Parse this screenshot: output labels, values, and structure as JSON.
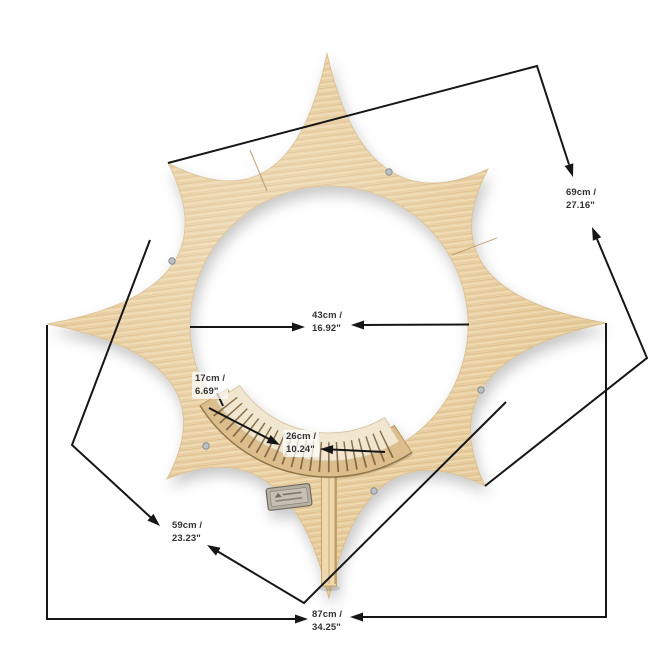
{
  "diagram": {
    "type": "product-dimension-diagram",
    "background_color": "#ffffff",
    "line_color": "#161616",
    "label_text_color": "#333333",
    "product": {
      "description": "eight-point sun-shaped wooden wall shelf with round opening, slotted display rack, support leg and brand plaque",
      "wood_color": "#e9cfa0",
      "wood_grain_color": "#cfa96e",
      "rack_card_color": "#f1e7d0",
      "rack_slot_color": "#775c38",
      "leg_color": "#eed9ae",
      "plaque_color": "#b6b0a4",
      "screw_color": "#b9c0c6"
    },
    "dimensions": {
      "height": {
        "cm": "69cm /",
        "inch": "27.16\""
      },
      "opening_diameter": {
        "cm": "43cm /",
        "inch": "16.92\""
      },
      "rack_depth": {
        "cm": "17cm /",
        "inch": "6.69\""
      },
      "rack_width": {
        "cm": "26cm /",
        "inch": "10.24\""
      },
      "side": {
        "cm": "59cm /",
        "inch": "23.23\""
      },
      "width": {
        "cm": "87cm /",
        "inch": "34.25\""
      }
    }
  }
}
